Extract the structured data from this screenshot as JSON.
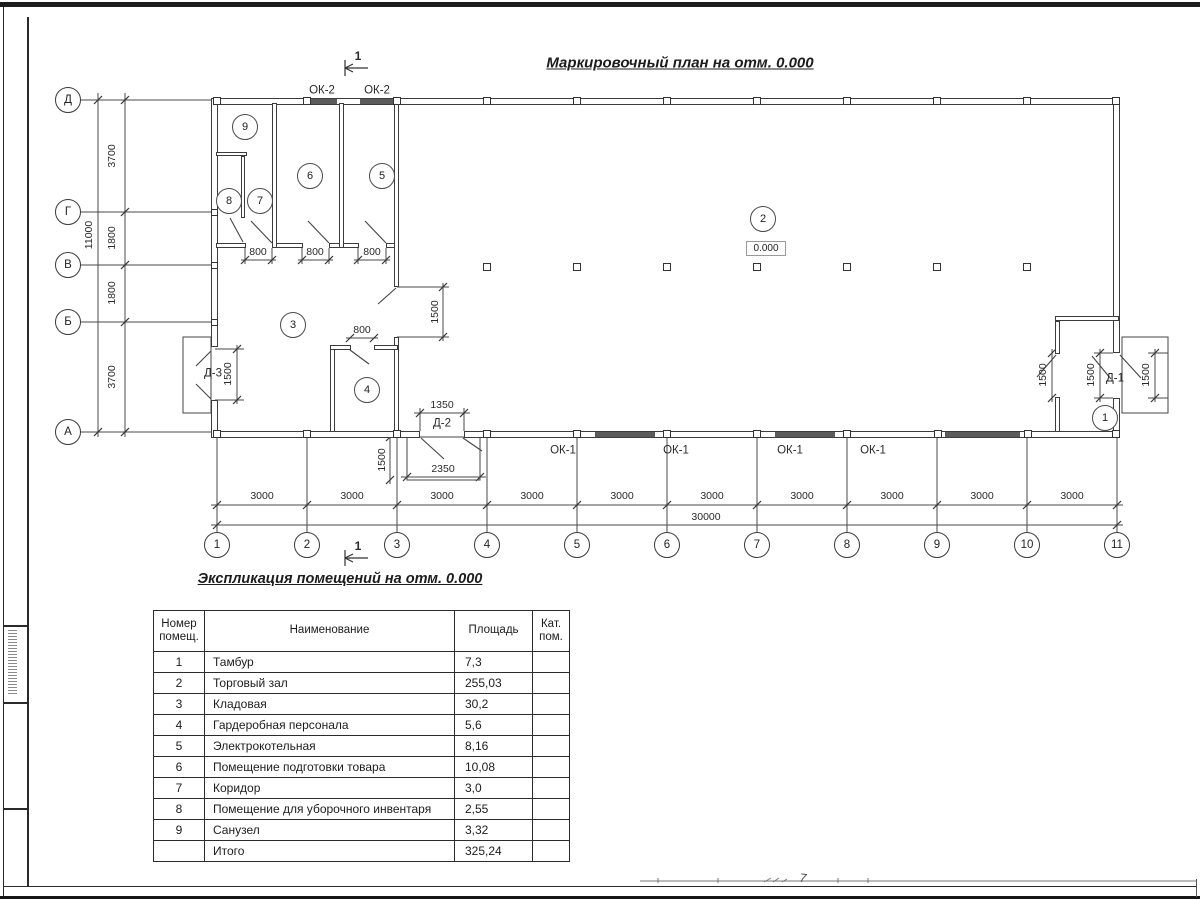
{
  "sheet": {
    "bottom_page_mark": "7"
  },
  "plan": {
    "title": "Маркировочный план на отм. 0.000",
    "section_label": "1",
    "elevation": "0.000",
    "room_tags": [
      "1",
      "2",
      "3",
      "4",
      "5",
      "6",
      "7",
      "8",
      "9"
    ],
    "marks": {
      "ok1": "ОК-1",
      "ok2": "ОК-2",
      "d1": "Д-1",
      "d2": "Д-2",
      "d3": "Д-3"
    },
    "axes_vertical": [
      "Д",
      "Г",
      "В",
      "Б",
      "А"
    ],
    "axes_horizontal": [
      "1",
      "2",
      "3",
      "4",
      "5",
      "6",
      "7",
      "8",
      "9",
      "10",
      "11"
    ],
    "dims": {
      "v_segments": [
        "3700",
        "1800",
        "1800",
        "3700"
      ],
      "v_total": "11000",
      "bay": "3000",
      "h_total": "30000",
      "door800": "800",
      "d1500": "1500",
      "d1350": "1350",
      "d2350": "2350"
    }
  },
  "schedule": {
    "title": "Экспликация помещений на отм. 0.000",
    "headers": {
      "num": "Номер помещ.",
      "name": "Наименование",
      "area": "Площадь",
      "cat": "Кат. пом."
    },
    "rows": [
      {
        "num": "1",
        "name": "Тамбур",
        "area": "7,3",
        "cat": ""
      },
      {
        "num": "2",
        "name": "Торговый зал",
        "area": "255,03",
        "cat": ""
      },
      {
        "num": "3",
        "name": "Кладовая",
        "area": "30,2",
        "cat": ""
      },
      {
        "num": "4",
        "name": "Гардеробная персонала",
        "area": "5,6",
        "cat": ""
      },
      {
        "num": "5",
        "name": "Электрокотельная",
        "area": "8,16",
        "cat": ""
      },
      {
        "num": "6",
        "name": "Помещение подготовки товара",
        "area": "10,08",
        "cat": ""
      },
      {
        "num": "7",
        "name": "Коридор",
        "area": "3,0",
        "cat": ""
      },
      {
        "num": "8",
        "name": "Помещение для уборочного инвентаря",
        "area": "2,55",
        "cat": ""
      },
      {
        "num": "9",
        "name": "Санузел",
        "area": "3,32",
        "cat": ""
      },
      {
        "num": "",
        "name": "Итого",
        "area": "325,24",
        "cat": ""
      }
    ]
  }
}
